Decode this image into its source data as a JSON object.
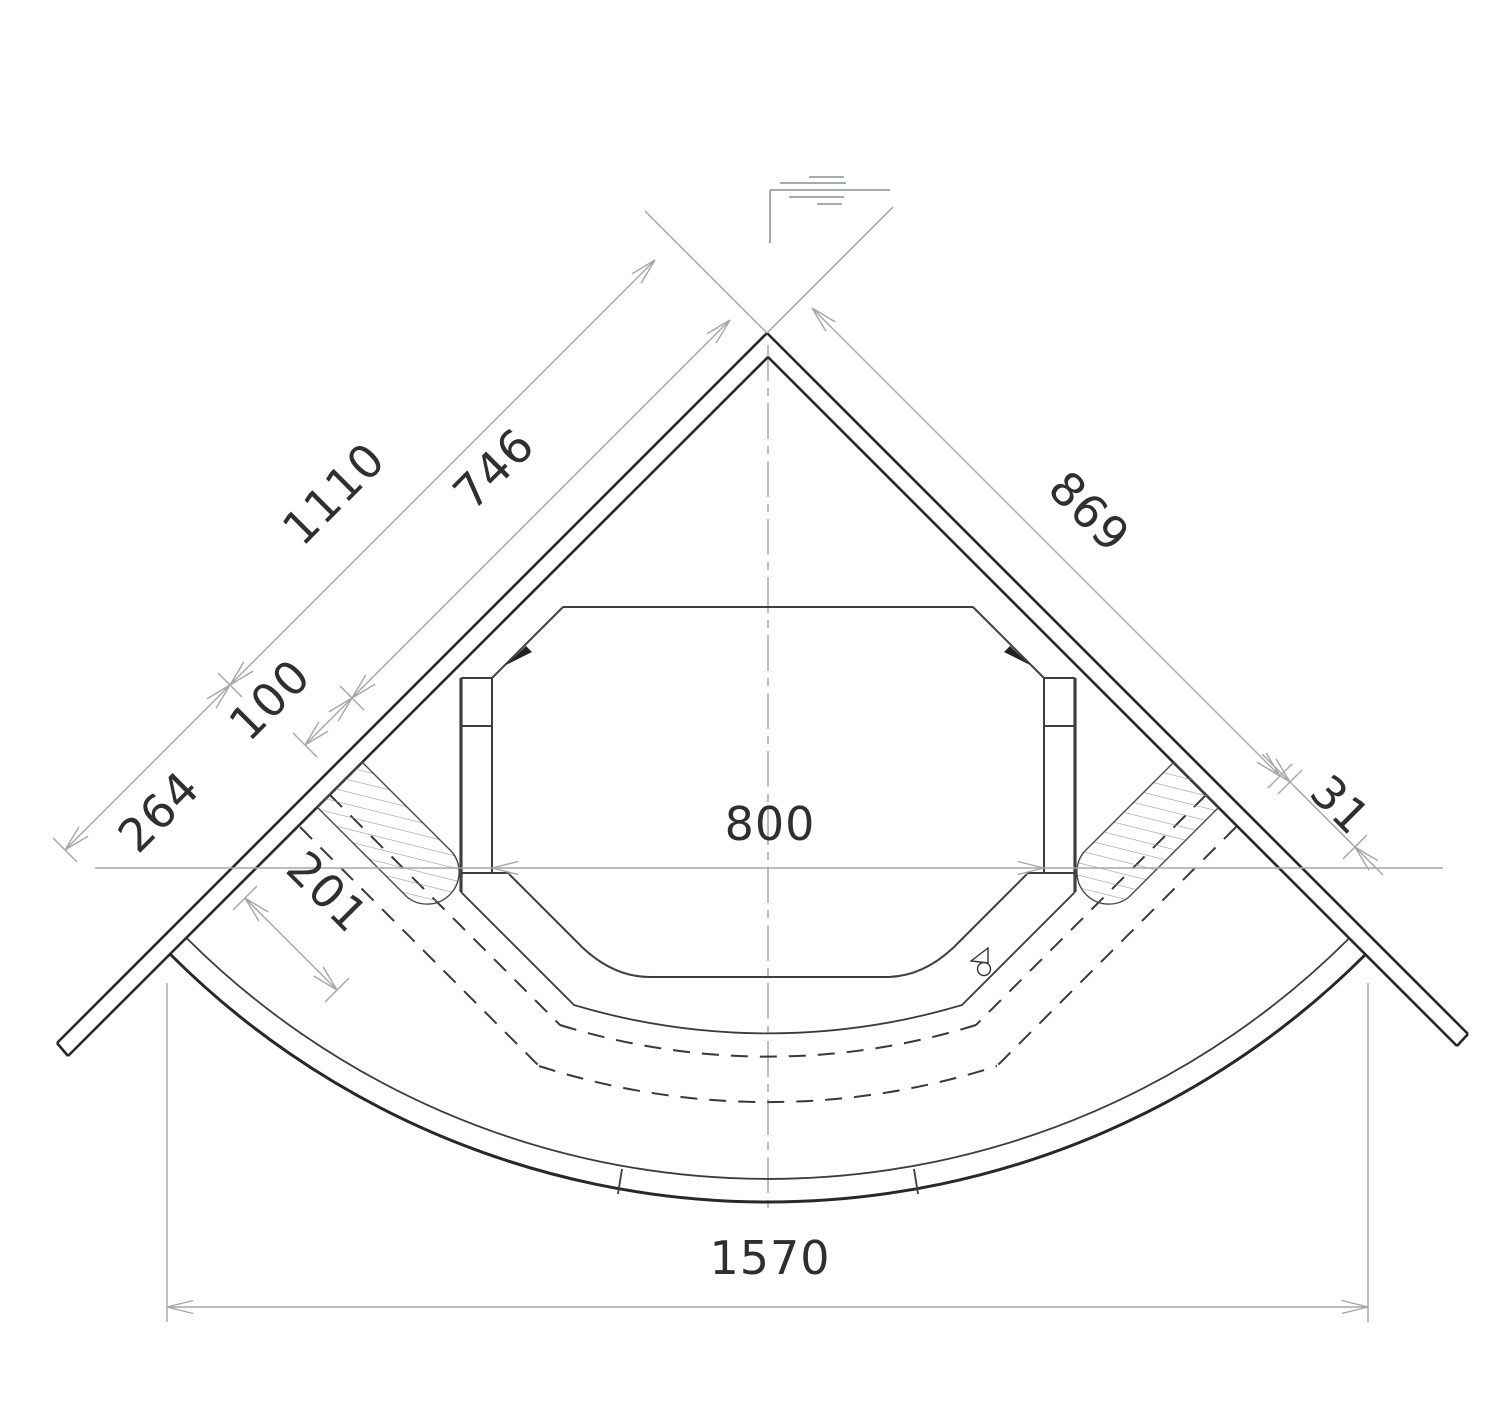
{
  "drawing": {
    "dimensions": {
      "d1110": "1110",
      "d746": "746",
      "d869": "869",
      "d100": "100",
      "d264": "264",
      "d201": "201",
      "d800": "800",
      "d31": "31",
      "d1570": "1570"
    }
  }
}
